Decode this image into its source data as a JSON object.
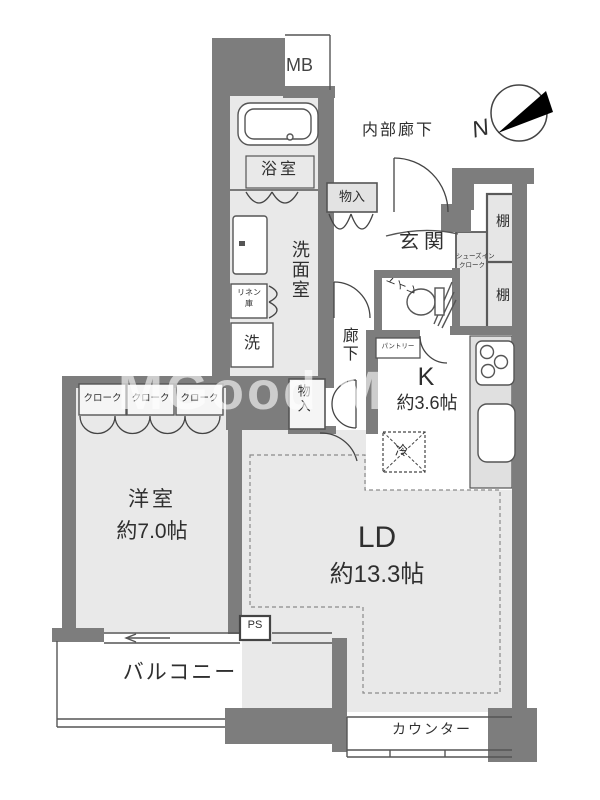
{
  "rooms": {
    "bathroom": {
      "label": "浴室"
    },
    "washroom": {
      "label": "洗面室"
    },
    "toilet": {
      "label": "トイレ"
    },
    "entrance": {
      "label": "玄関"
    },
    "corridor": {
      "label": "廊下"
    },
    "inner_corridor": {
      "label": "内部廊下"
    },
    "kitchen": {
      "label": "K",
      "size": "約3.6帖"
    },
    "living_dining": {
      "label": "LD",
      "size": "約13.3帖"
    },
    "western_room": {
      "label": "洋室",
      "size": "約7.0帖"
    },
    "balcony": {
      "label": "バルコニー"
    }
  },
  "storage": {
    "mb": "MB",
    "closet_upper": "物入",
    "closet_mid": "物入",
    "shelf_upper": "棚",
    "shelf_lower": "棚",
    "sic_line1": "シューズイン",
    "sic_line2": "クローク",
    "linen_line1": "リネン",
    "linen_line2": "庫",
    "washer": "洗",
    "pantry": "パントリー",
    "fridge": "冷",
    "cloak1": "クローク",
    "cloak2": "クローク",
    "cloak3": "クローク",
    "ps": "PS"
  },
  "fixtures": {
    "counter": "カウンター"
  },
  "compass": {
    "north": "N"
  },
  "watermark": {
    "text": "MGood M"
  },
  "colors": {
    "wall": "#7d7d7d",
    "room_fill": "#e9e9e9",
    "storage_fill": "#e3e3e3",
    "line": "#555555",
    "text": "#2f2f2f",
    "compass_pointer": "#000000"
  }
}
